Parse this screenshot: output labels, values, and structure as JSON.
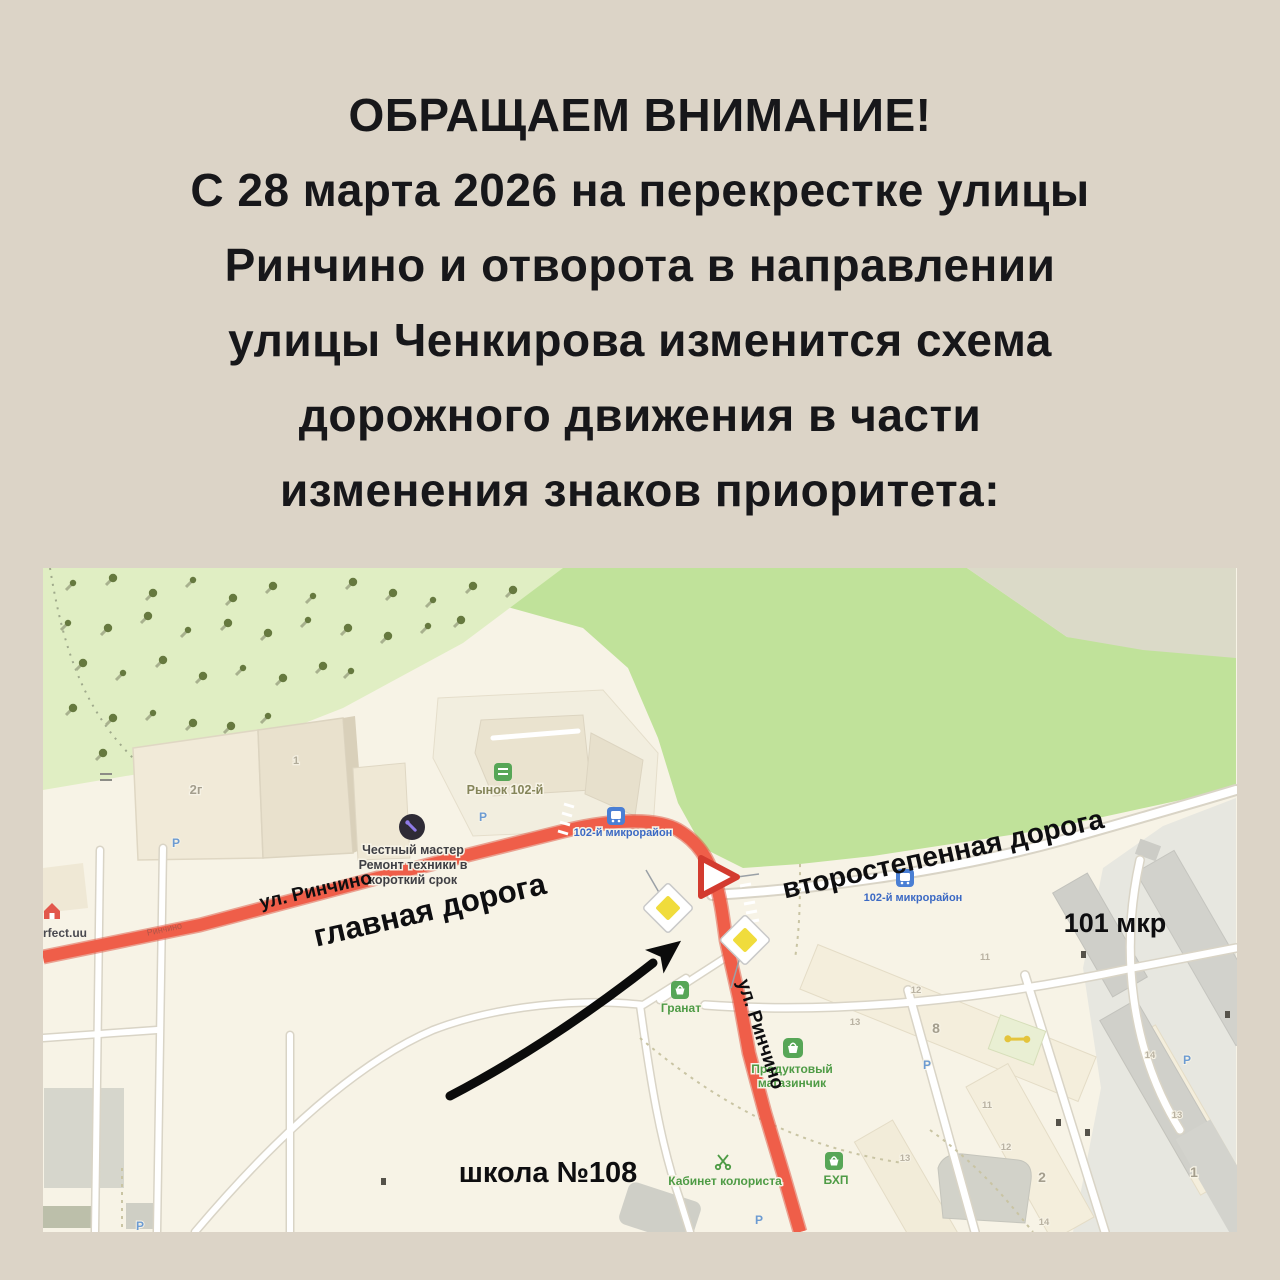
{
  "poster": {
    "title_lines": [
      "ОБРАЩАЕМ ВНИМАНИЕ!",
      "С 28 марта 2026 на перекрестке улицы",
      "Ринчино и отворота в направлении",
      "улицы Ченкирова изменится схема",
      "дорожного движения в части",
      "изменения знаков приоритета:"
    ]
  },
  "map": {
    "overlay": {
      "main_road": "главная дорога",
      "secondary_road": "второстепенная дорога",
      "street_label_top": "ул. Ринчино",
      "street_label_side": "ул. Ринчино",
      "district": "101 мкр",
      "school": "школа №108"
    },
    "poi": {
      "bus_stop_top": "102-й микрорайон",
      "bus_stop_right": "102-й микрорайон",
      "market": "Рынок 102-й",
      "repair_shop_lines": [
        "Честный мастер",
        "Ремонт техники в",
        "короткий срок"
      ],
      "granat": "Гранат",
      "grocery_lines": [
        "Продуктовый",
        "магазинчик"
      ],
      "bhp": "БХП",
      "colorist": "Кабинет колориста",
      "website": "perfect.uu",
      "street_small": "Ринчино",
      "parking": "P"
    },
    "buildings": {
      "b2g": "2г",
      "b1_top": "1",
      "b8": "8",
      "b2": "2",
      "b1": "1"
    },
    "entrances": [
      "11",
      "12",
      "13",
      "11",
      "12",
      "14",
      "14",
      "13",
      "13"
    ],
    "colors": {
      "poster_bg": "#DCD4C7",
      "map_cream": "#F7F3E6",
      "field_green": "#C0E29A",
      "forest_green": "#E0EEC3",
      "gray_corner": "#DBDAC8",
      "road_red": "#EF5E49",
      "sign_yellow": "#F0DC3C",
      "giveway_red": "#D33B2F",
      "poi_green": "#4E9B45",
      "poi_blue": "#3B69C4",
      "annotation_black": "#0E0E10"
    }
  }
}
